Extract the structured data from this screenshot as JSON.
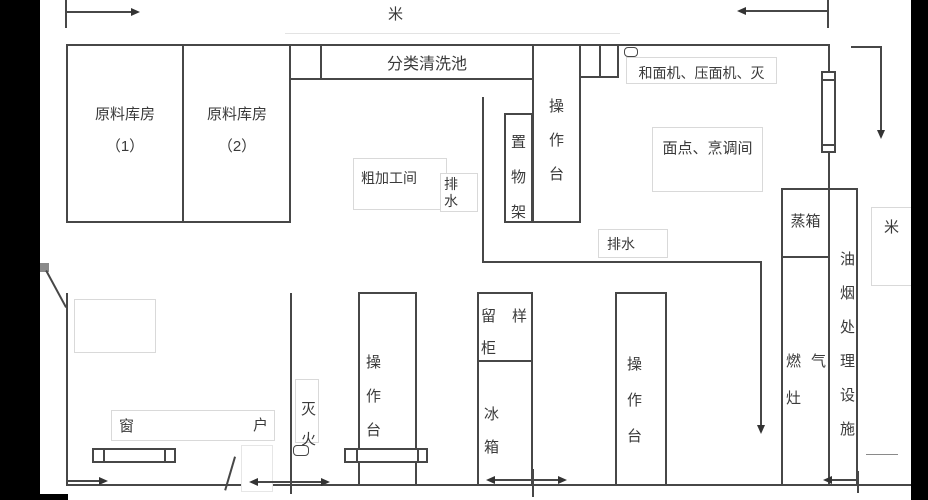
{
  "scale_marks": {
    "top": "米",
    "right": "米"
  },
  "rooms": {
    "storage1_name": "原料库房",
    "storage1_num": "（1）",
    "storage2_name": "原料库房",
    "storage2_num": "（2）",
    "wash_pool": "分类清洗池",
    "rough_processing": "粗加工间",
    "pastry_cooking": "面点、烹调间"
  },
  "equipment": {
    "prep_table_top": "操作台",
    "storage_rack": "置物架",
    "machines": "和面机、压面机、灭",
    "drain_upper": "排水",
    "drain_lower": "排水",
    "steamer": "蒸箱",
    "gas_stove": "燃气灶",
    "fume_treatment": "油烟处理设施",
    "sample_cabinet": "留样柜",
    "refrigerator": "冰箱",
    "prep_table_left": "操作台",
    "prep_table_middle": "操作台",
    "fire_extinguisher": "灭火",
    "window_char_left": "窗",
    "window_char_right": "户"
  }
}
